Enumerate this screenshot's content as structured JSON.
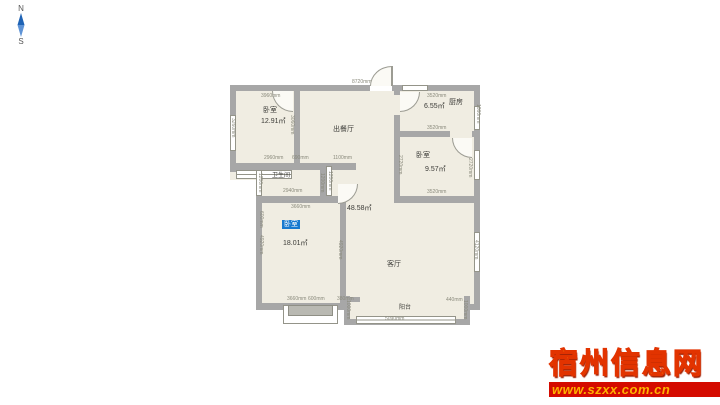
{
  "compass": {
    "north": "N",
    "south": "S"
  },
  "rooms": {
    "bedroom1": {
      "name": "卧室",
      "area": "12.91㎡"
    },
    "dining": {
      "name": "出餐厅"
    },
    "kitchen": {
      "name": "厨房",
      "area": "6.55㎡"
    },
    "bedroom2": {
      "name": "卧室",
      "area": "9.57㎡"
    },
    "bathroom": {
      "name": "卫生间"
    },
    "bedroom3": {
      "name": "卧室",
      "area": "18.01㎡"
    },
    "living": {
      "name": "客厅"
    },
    "balcony": {
      "name": "阳台"
    },
    "open_area": {
      "area": "48.58㎡"
    }
  },
  "dims": {
    "d3960": "3960mm",
    "d3260": "3260mm",
    "d3060": "3060mm",
    "d8720": "8720mm",
    "d2960": "2960mm",
    "d690": "690mm",
    "d1100": "1100mm",
    "d2940": "2940mm",
    "d1200": "1200mm",
    "d3660": "3660mm",
    "d3520": "3520mm",
    "d1860": "1860mm",
    "d2720": "2720mm",
    "d4920": "4920mm",
    "d600": "600mm",
    "d4120": "4120mm",
    "d380": "380mm",
    "d1000": "1000mm",
    "d440": "440mm",
    "d5090": "5090mm"
  },
  "watermark": {
    "site_name": "宿州信息网",
    "url": "www.szxx.com.cn"
  },
  "colors": {
    "wall": "#a7a7a7",
    "floor": "#f0ede2",
    "highlight": "#1879cf",
    "watermark_red": "#d40b00",
    "watermark_gold": "#ffb803",
    "compass_blue": "#2e6fc4"
  }
}
